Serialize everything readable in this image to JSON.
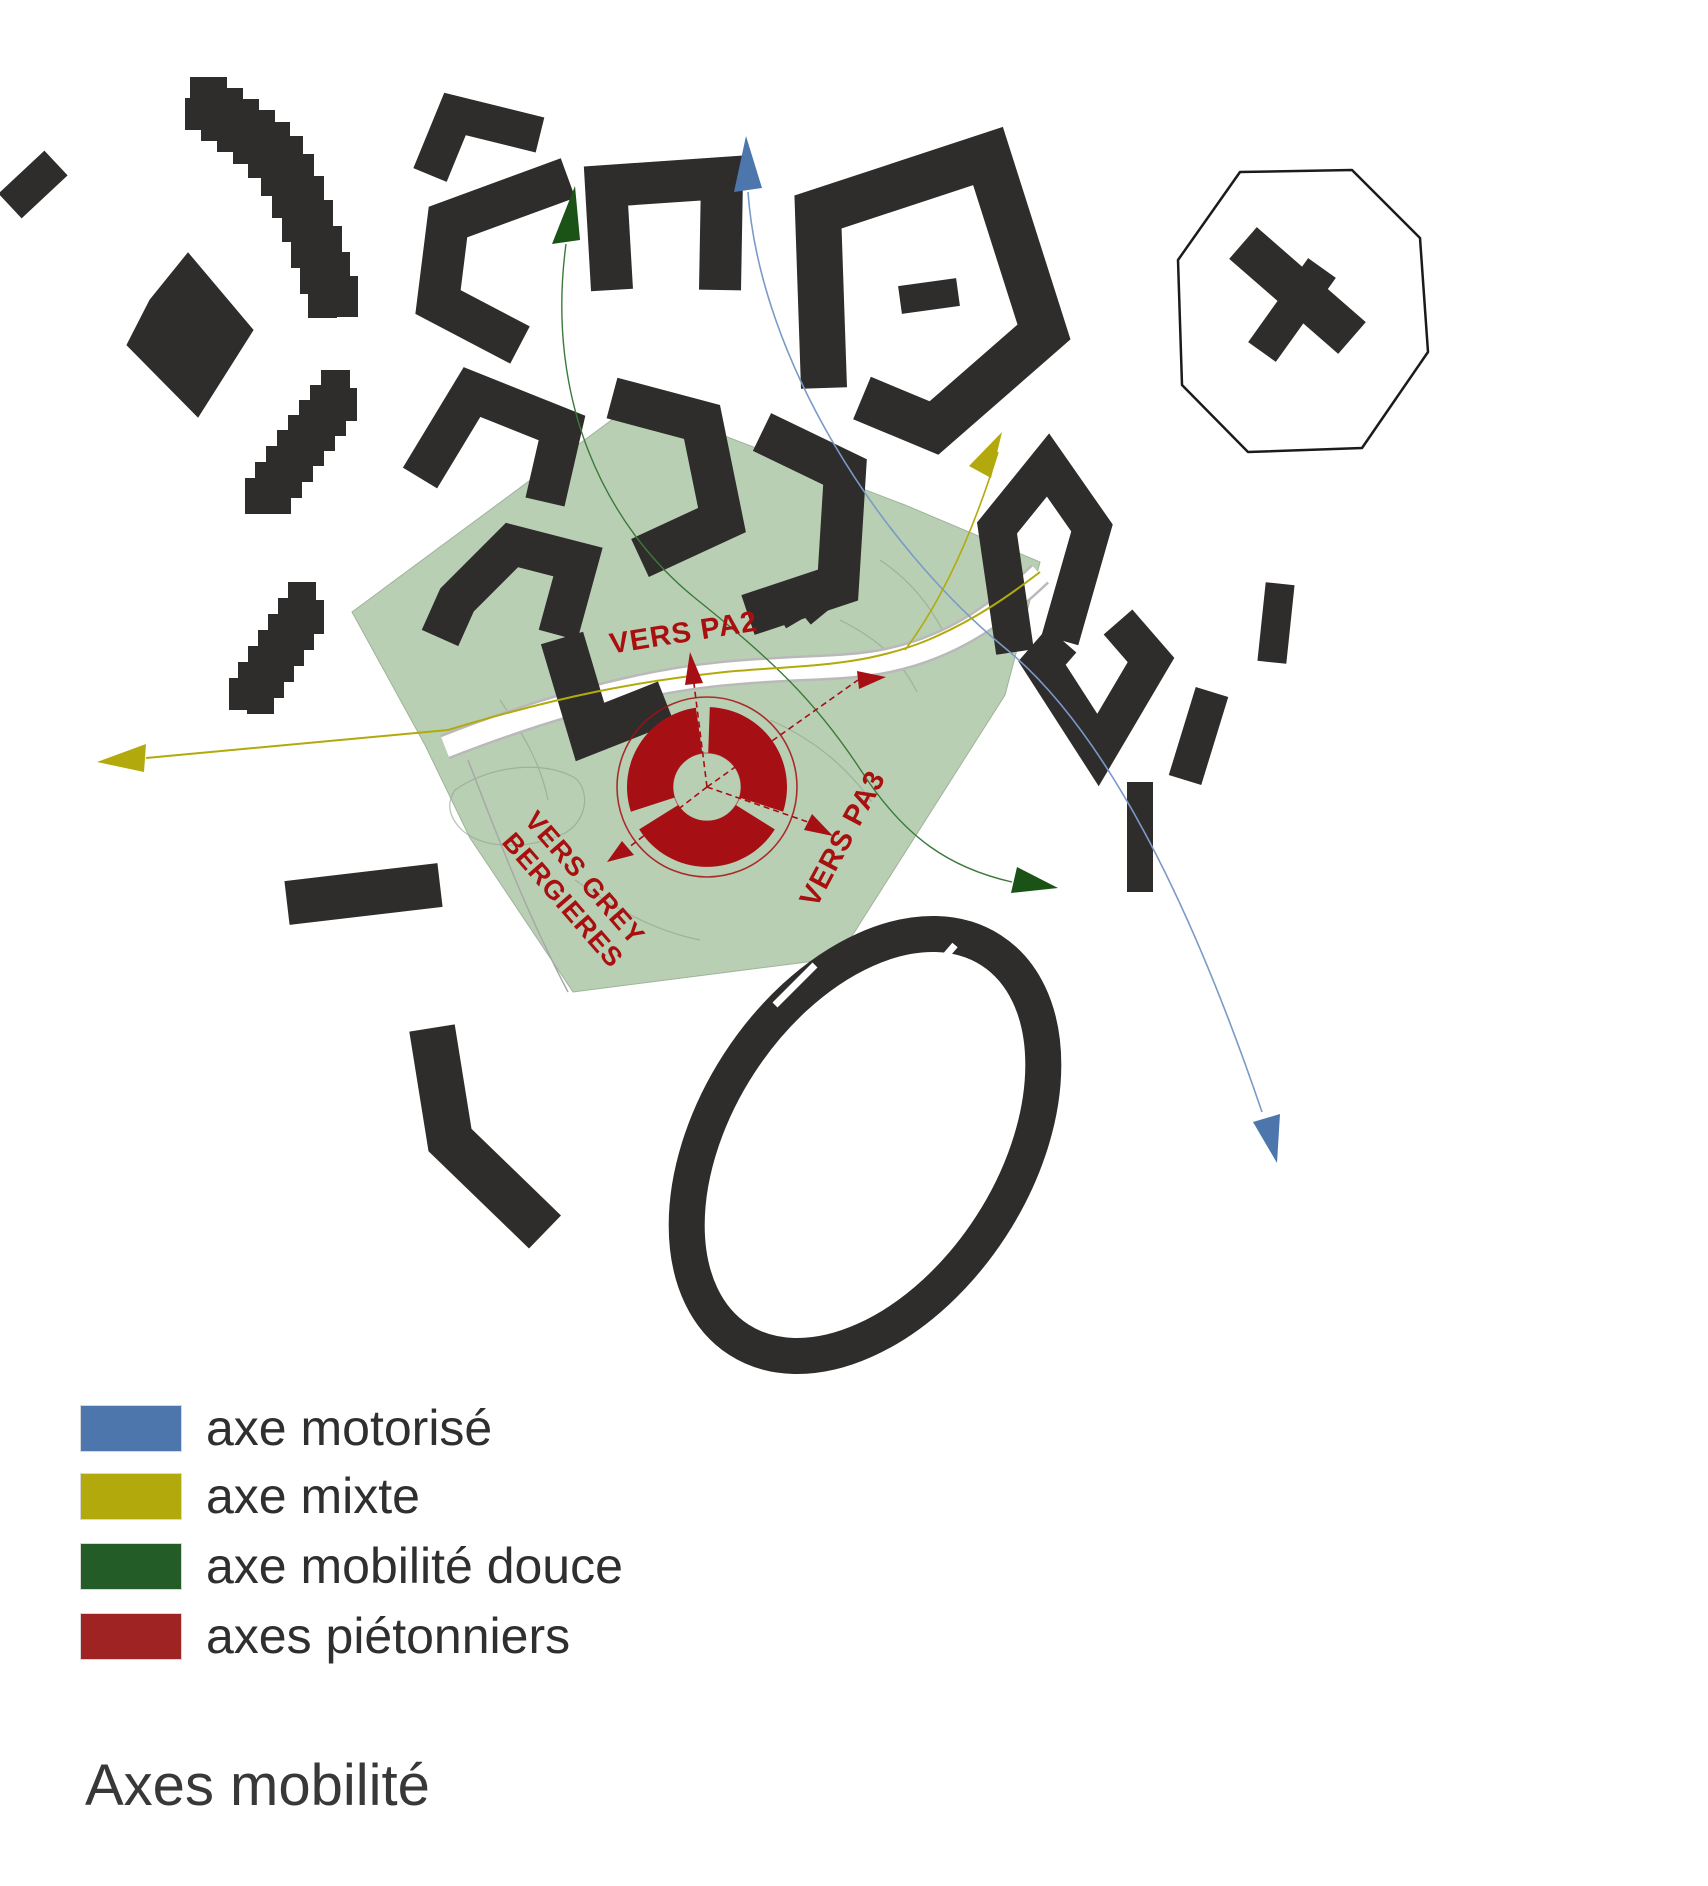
{
  "title": "Axes mobilité",
  "legend": {
    "items": [
      {
        "label": "axe motorisé",
        "color_key": "blue",
        "color": "#4d76ac"
      },
      {
        "label": "axe mixte",
        "color_key": "yellow",
        "color": "#b2aa0c"
      },
      {
        "label": "axe mobilité douce",
        "color_key": "green",
        "color": "#235c26"
      },
      {
        "label": "axes piétonniers",
        "color_key": "red",
        "color": "#9e2322"
      }
    ]
  },
  "map": {
    "labels": {
      "pa2": "VERS PA2",
      "pa3": "VERS PA3",
      "grey_line1": "VERS GREY",
      "grey_line2": "BERGIERES"
    }
  },
  "colors": {
    "blue": "#4d76ac",
    "blue-line": "#7b9ac7",
    "yellow": "#b2aa0c",
    "yellow-line": "#b2aa0c",
    "green": "#235c26",
    "green-arrow": "#1b5317",
    "green-line": "#3c7a3b",
    "red": "#9e2322",
    "map-red": "#a60f13",
    "red-text": "#a8100f",
    "building": "#2e2d2c",
    "zone-green": "#b9cfb4",
    "road-edge": "#b9b9b9",
    "plot-line": "#8fa58c"
  }
}
